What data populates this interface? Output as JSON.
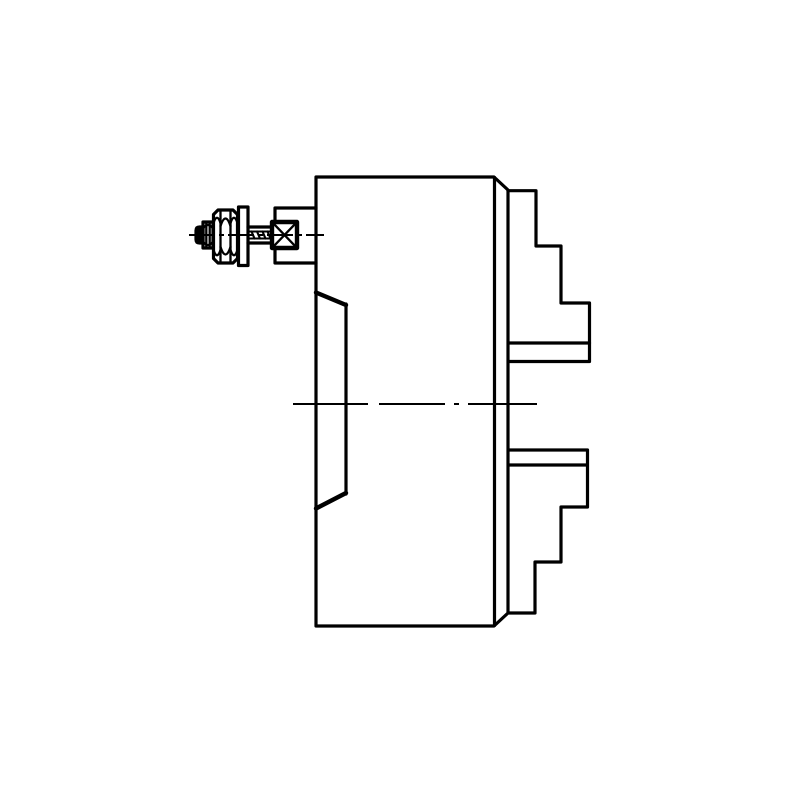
{
  "figure": {
    "kind": "technical-line-drawing",
    "subject": "lathe-chuck-side-view",
    "background_color": "#ffffff",
    "line_color": "#000000"
  },
  "drawing": {
    "canvas": {
      "width": 800,
      "height": 800
    },
    "stroke_widths": {
      "regular": 3.2,
      "bold": 4.4,
      "medium": 2.3,
      "thin": 2.1
    },
    "paths": [
      {
        "name": "chuck-body-outline",
        "d": "M316 177 L494 177 L508 190 L508 613 L494 626 L316 626 Z",
        "w": "regular"
      },
      {
        "name": "chuck-face-chamfer-line",
        "d": "M494.5 177.5 L494.5 625.5",
        "w": "regular"
      },
      {
        "name": "top-jaw-outline",
        "d": "M508 190.7 L536 190.7 L536 246 L561 246 L561 303 L589.5 303 L589.5 361.5 L509 361.5",
        "w": "regular"
      },
      {
        "name": "top-jaw-seam-line",
        "d": "M509 343 L589.5 343",
        "w": "regular"
      },
      {
        "name": "bottom-jaw-outline",
        "d": "M509 450 L587.5 450 L587.5 507 L561 507 L561 562 L535 562 L535 613 L509 613",
        "w": "regular"
      },
      {
        "name": "bottom-jaw-seam-line",
        "d": "M509 465 L587 465",
        "w": "regular"
      },
      {
        "name": "mount-boss-bracket",
        "d": "M316 208 L275 208 L275 263 L316 263",
        "w": "regular"
      },
      {
        "name": "jaw-guide-chamfer-top",
        "d": "M316 292.5 L346 305",
        "w": "bold"
      },
      {
        "name": "jaw-guide-edge-line",
        "d": "M346 304 L346 494",
        "w": "regular"
      },
      {
        "name": "jaw-guide-chamfer-bottom",
        "d": "M346 493 L316 508.5",
        "w": "bold"
      },
      {
        "name": "screw-tip",
        "d": "M203 227 L199.5 227 Q196 227 196 230.5 L196 239.5 Q196 243 199.5 243 L203 243 Z",
        "w": "regular"
      },
      {
        "name": "screw-tip-facet-lines",
        "d": "M198.3 227.6 L198.3 242.4 M200.4 227.2 L200.4 242.8 M202.2 227 L202.2 243",
        "w": "medium"
      },
      {
        "name": "screw-collar",
        "d": "M203 222 L213 222 L213 248 L203 248 Z",
        "w": "regular"
      },
      {
        "name": "screw-collar-facet-lines",
        "d": "M206.3 222 L206.3 248 M209.7 222 L209.7 248",
        "w": "medium"
      },
      {
        "name": "screw-collar-arcs",
        "d": "M203 228.5 Q208 221.5 213 228.5 M203 241.5 Q208 248.5 213 241.5",
        "w": "medium"
      },
      {
        "name": "screw-hex-head",
        "d": "M213.5 214.5 L218 210 L233 210 L237.5 214.5 L237.5 258.5 L233 263 L218 263 L213.5 258.5 Z",
        "w": "regular"
      },
      {
        "name": "screw-hex-facet-lines",
        "d": "M220.5 210.5 L220.5 262.5 M230.5 210.5 L230.5 262.5",
        "w": "medium"
      },
      {
        "name": "screw-hex-arcs",
        "d": "M213.5 223 Q217 212.5 220.5 223 M220.5 226 Q225.5 211 230.5 226 M230.5 223 Q234 212.5 237.5 223 M213.5 250 Q217 260.5 220.5 250 M220.5 247 Q225.5 262 230.5 247 M230.5 250 Q234 260.5 237.5 250",
        "w": "medium"
      },
      {
        "name": "washer",
        "d": "M238.5 207 L248 207 L248 265.5 L238.5 265.5 Z",
        "w": "regular"
      },
      {
        "name": "screw-shank-outline",
        "d": "M248 227 L272 227 M248 243 L272 243",
        "w": "regular"
      },
      {
        "name": "screw-shank-thread-lines",
        "d": "M248 231.5 L272 231.5 M248 238.5 L272 238.5",
        "w": "thin"
      },
      {
        "name": "screw-thread-ticks",
        "d": "M251.5 231.5 L254.5 238.5 M257 231.5 L260 238.5 M262.5 231.5 L265.5 238.5 M267.5 231.5 L270.5 238.5",
        "w": "thin"
      },
      {
        "name": "drive-socket-box",
        "d": "M272 222 L297 222 L297 248 L272 248 Z",
        "w": "bold",
        "fill": "#ffffff"
      },
      {
        "name": "drive-socket-cross",
        "d": "M272.8 222.8 L296.2 247.2 M296.2 222.8 L272.8 247.2",
        "w": "medium"
      }
    ],
    "centerlines": [
      {
        "name": "screw-axis-centerline",
        "d": "M189 235 L324 235",
        "w": "thin",
        "dash": "26 4 5 4"
      },
      {
        "name": "main-axis-centerline",
        "d": "M293 404 L537 404",
        "w": "thin",
        "dash": "75 11 66 9 5 9"
      }
    ]
  }
}
